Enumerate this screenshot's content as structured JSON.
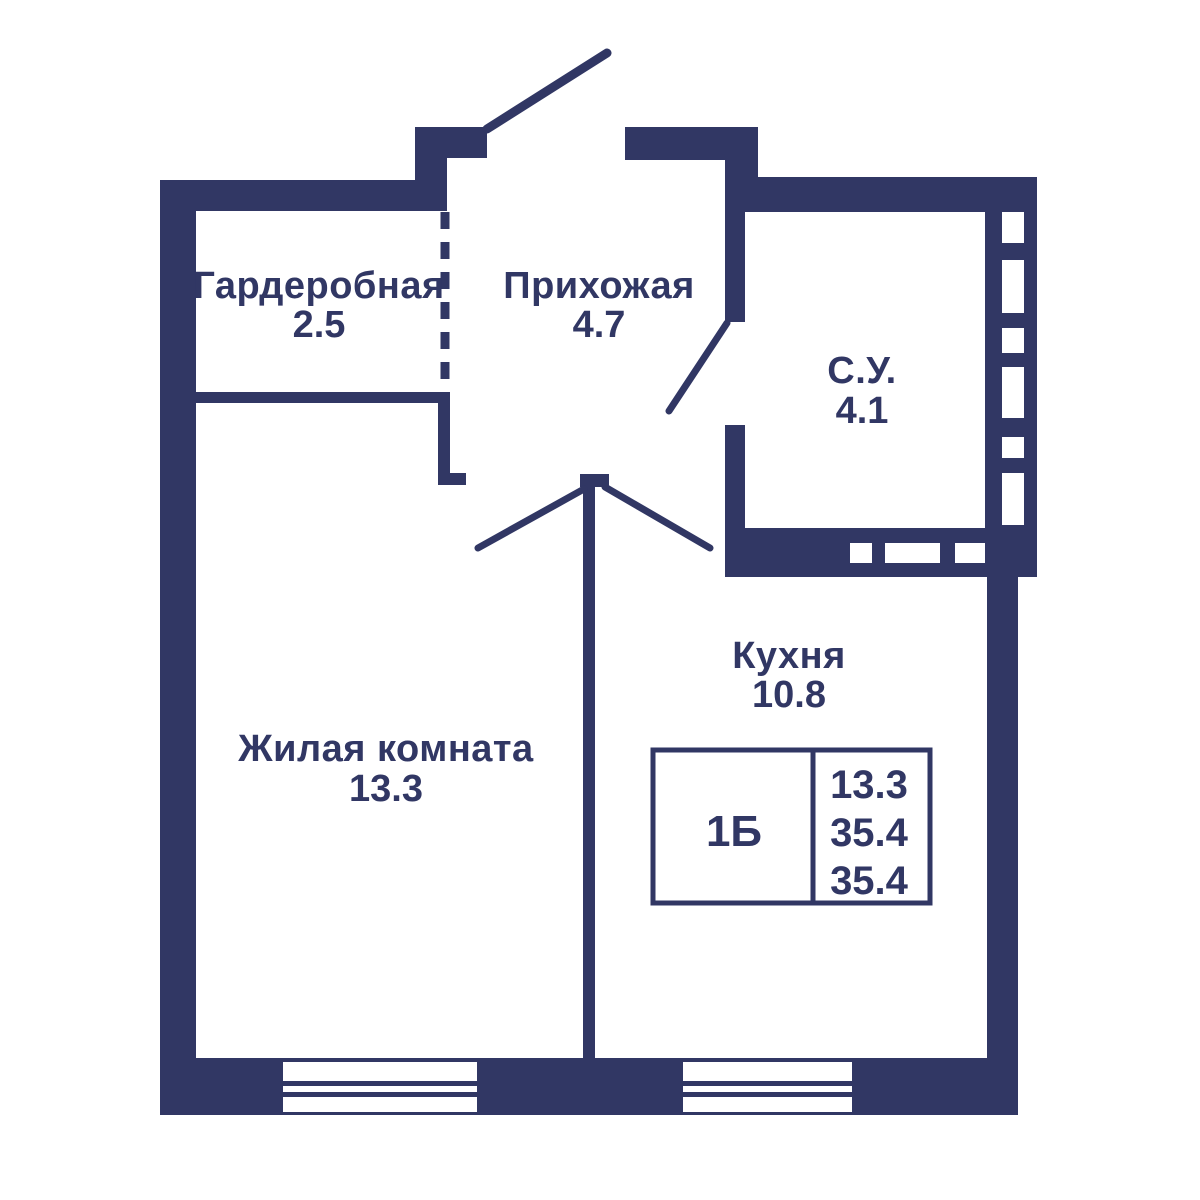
{
  "plan": {
    "wall_color": "#313764",
    "background_color": "#ffffff",
    "rooms": [
      {
        "name": "Гардеробная",
        "area": "2.5"
      },
      {
        "name": "Прихожая",
        "area": "4.7"
      },
      {
        "name": "С.У.",
        "area": "4.1"
      },
      {
        "name": "Кухня",
        "area": "10.8"
      },
      {
        "name": "Жилая комната",
        "area": "13.3"
      }
    ],
    "legend": {
      "unit": "1Б",
      "rows": [
        "13.3",
        "35.4",
        "35.4"
      ]
    }
  }
}
